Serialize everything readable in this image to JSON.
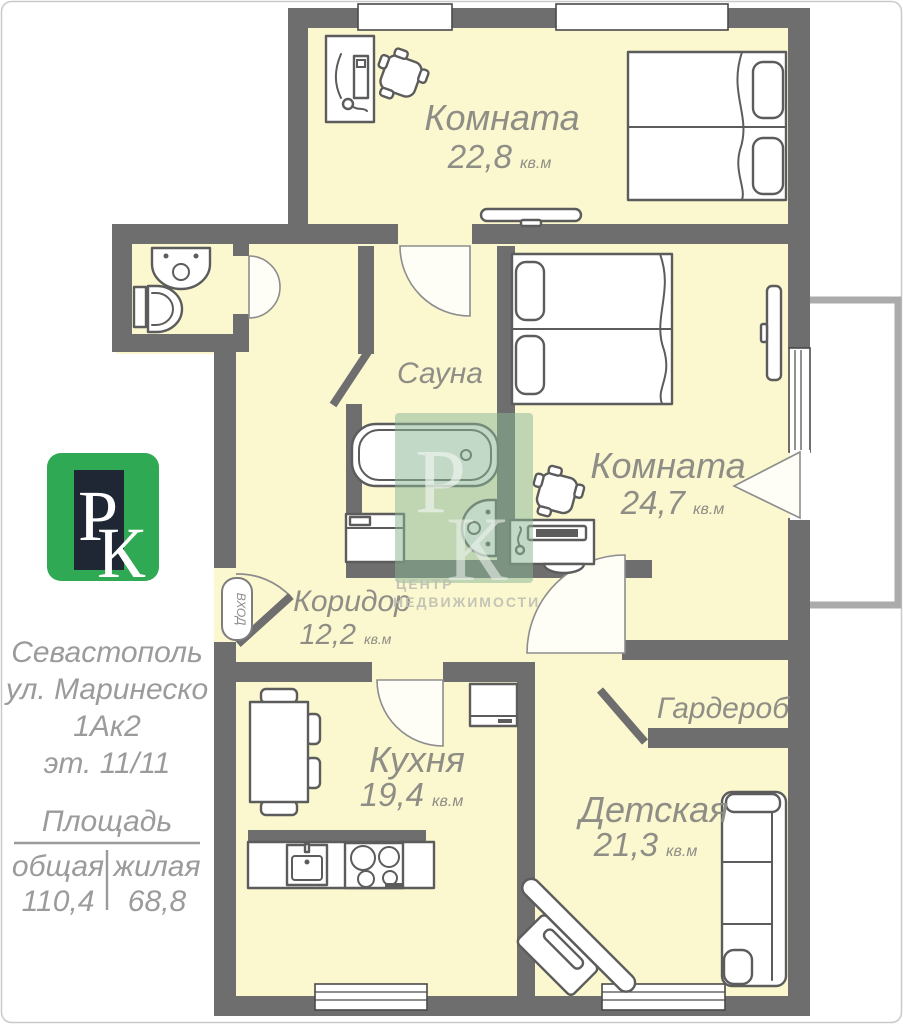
{
  "plan": {
    "entrance_label": "ВХОД",
    "rooms": [
      {
        "name": "Комната",
        "area": "22,8",
        "unit": "кв.м"
      },
      {
        "name": "Сауна",
        "area": "",
        "unit": ""
      },
      {
        "name": "Комната",
        "area": "24,7",
        "unit": "кв.м"
      },
      {
        "name": "Коридор",
        "area": "12,2",
        "unit": "кв.м"
      },
      {
        "name": "Кухня",
        "area": "19,4",
        "unit": "кв.м"
      },
      {
        "name": "Гардероб",
        "area": "",
        "unit": ""
      },
      {
        "name": "Детская",
        "area": "21,3",
        "unit": "кв.м"
      }
    ]
  },
  "sidebar": {
    "logo": {
      "letter_p": "Р",
      "letter_k": "К"
    },
    "address": {
      "city": "Севастополь",
      "street": "ул. Маринеско",
      "building": "1Ак2",
      "floor": "эт. 11/11"
    },
    "area_block": {
      "title": "Площадь",
      "columns": [
        {
          "label": "общая",
          "value": "110,4"
        },
        {
          "label": "жилая",
          "value": "68,8"
        }
      ]
    }
  },
  "watermark": {
    "letter_p": "Р",
    "letter_k": "К",
    "line1": "ЦЕНТР",
    "line2": "НЕДВИЖИМОСТИ"
  },
  "colors": {
    "wall": "#6e6e6e",
    "room_fill": "#FBF7CF",
    "label_gray": "#8e8e86",
    "sidebar_gray": "#9b9b9b",
    "logo_green": "#2fa953",
    "logo_dark": "#1e2733",
    "watermark_green": "#8ab795"
  }
}
